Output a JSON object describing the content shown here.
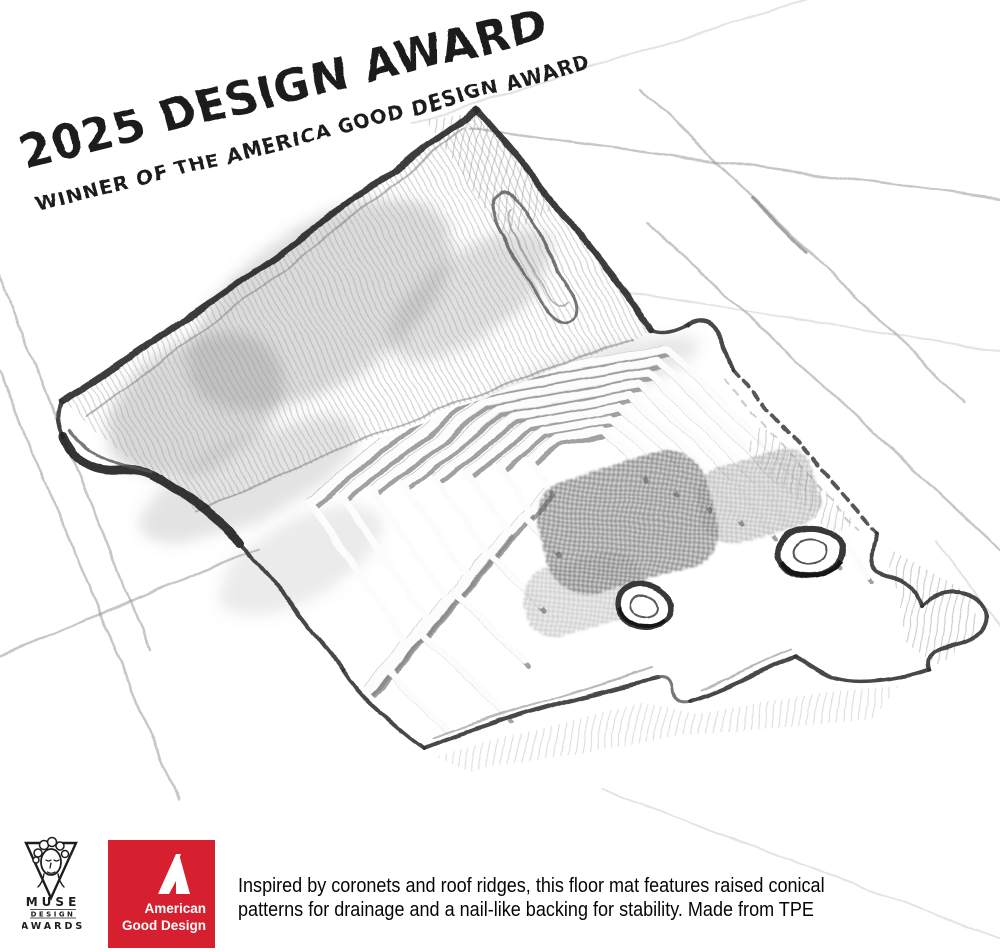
{
  "award_overlay": {
    "line1": "2025 DESIGN AWARD",
    "line2": "WINNER OF THE AMERICA GOOD DESIGN AWARD",
    "ink_color": "#1c1c1c"
  },
  "badges": {
    "muse": {
      "icon": "muse-goddess-triangle-icon",
      "line1": "MUSE",
      "line2": "DESIGN",
      "line3": "AWARDS",
      "color": "#1d1d1d"
    },
    "agd": {
      "icon": "agd-stylized-a-icon",
      "line1": "American",
      "line2": "Good Design",
      "bg_color": "#d7202f",
      "text_color": "#ffffff"
    }
  },
  "caption": {
    "lines": [
      "Inspired by coronets and roof ridges, this floor mat features raised conical",
      "patterns for drainage and a nail-like backing for stability. Made from TPE"
    ]
  }
}
